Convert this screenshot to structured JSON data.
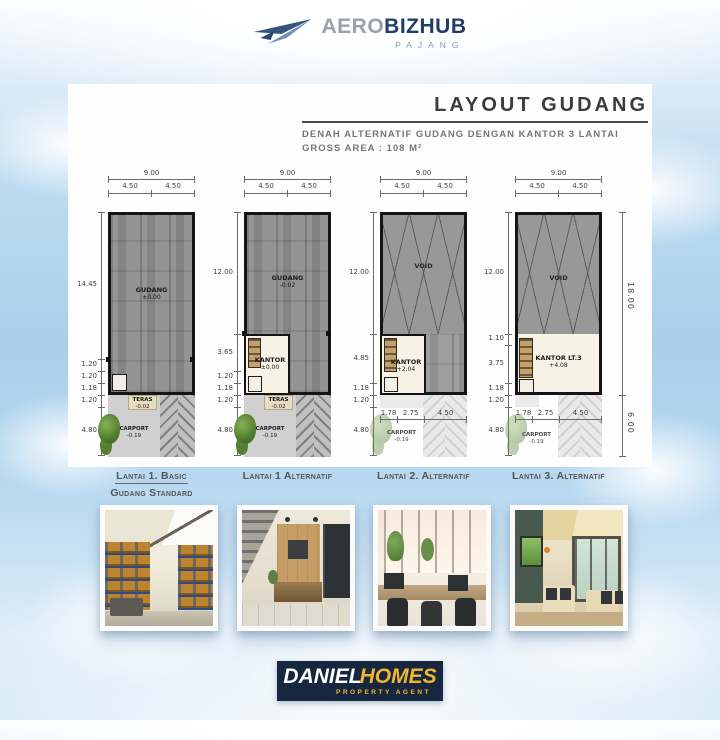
{
  "header": {
    "brand_part1": "AERO",
    "brand_part2": "BIZHUB",
    "brand_sub": "PAJANG"
  },
  "title_block": {
    "title": "LAYOUT GUDANG",
    "subtitle_line1": "DENAH ALTERNATIF GUDANG DENGAN KANTOR 3 LANTAI",
    "subtitle_line2": "GROSS AREA : 108 M²"
  },
  "plans": [
    {
      "top_total": "9.00",
      "top_halves": [
        "4.50",
        "4.50"
      ],
      "left_dims": [
        "14.45",
        "1.20",
        "1.20",
        "1.18",
        "1.20",
        "4.80"
      ],
      "rooms": [
        {
          "name": "GUDANG",
          "elev": "±0.00"
        },
        {
          "name": "TERAS",
          "elev": "-0.02"
        },
        {
          "name": "CARPORT",
          "elev": "-0.19"
        }
      ],
      "caption_line1": "Lantai 1. Basic",
      "caption_line2": "Gudang Standard"
    },
    {
      "top_total": "9.00",
      "top_halves": [
        "4.50",
        "4.50"
      ],
      "left_dims": [
        "12.00",
        "3.65",
        "1.20",
        "1.18",
        "1.20",
        "4.80"
      ],
      "rooms": [
        {
          "name": "GUDANG",
          "elev": "-0.02"
        },
        {
          "name": "KANTOR",
          "elev": "±0.00"
        },
        {
          "name": "TERAS",
          "elev": "-0.02"
        },
        {
          "name": "CARPORT",
          "elev": "-0.19"
        }
      ],
      "caption_line1": "Lantai 1 Alternatif"
    },
    {
      "top_total": "9.00",
      "top_halves": [
        "4.50",
        "4.50"
      ],
      "left_dims": [
        "12.00",
        "4.85",
        "1.18",
        "1.20",
        "4.80"
      ],
      "bottom_dims": [
        "1.78",
        "2.75",
        "4.50"
      ],
      "rooms": [
        {
          "name": "VOID",
          "elev": ""
        },
        {
          "name": "KANTOR",
          "elev": "+2.04"
        },
        {
          "name": "CARPORT",
          "elev": "-0.19"
        }
      ],
      "caption_line1": "Lantai 2. Alternatif"
    },
    {
      "top_total": "9.00",
      "top_halves": [
        "4.50",
        "4.50"
      ],
      "left_dims": [
        "12.00",
        "1.10",
        "3.75",
        "1.18",
        "1.20",
        "4.80"
      ],
      "bottom_dims": [
        "1.78",
        "2.75",
        "4.50"
      ],
      "rooms": [
        {
          "name": "VOID",
          "elev": ""
        },
        {
          "name": "KANTOR LT.3",
          "elev": "+4.08"
        },
        {
          "name": "CARPORT",
          "elev": "-0.19"
        }
      ],
      "caption_line1": "Lantai 3. Alternatif"
    }
  ],
  "right_dims": {
    "building": "18.00",
    "frontage": "6.00"
  },
  "footer": {
    "brand_part1": "DANIEL",
    "brand_part2": "HOMES",
    "tagline": "PROPERTY AGENT"
  },
  "colors": {
    "navy": "#16273f",
    "gold": "#f2b72e",
    "brand_blue": "#1f3f66",
    "sky": "#a9d0ea",
    "concrete": "#8e8e8e"
  }
}
